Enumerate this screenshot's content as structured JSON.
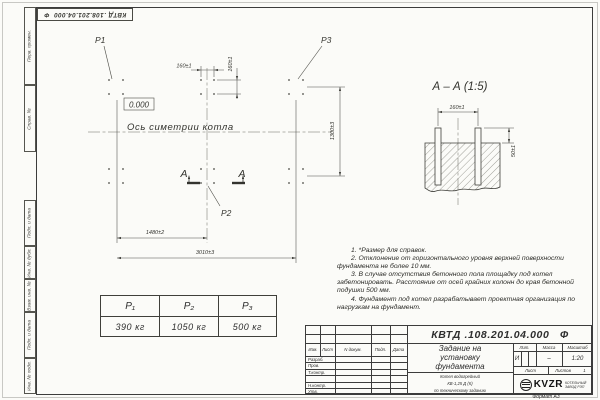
{
  "sheet": {
    "inverted_number": "КВТД .108.201.04.000  Ф",
    "format_note": "Формат А3"
  },
  "margin_labels": {
    "top": [
      "Перв. примен.",
      "Справ. №"
    ],
    "bottom": [
      "Подп. и дата",
      "Инв. № дубл.",
      "Взам. инв. №",
      "Подп. и дата",
      "Инв. № подл."
    ]
  },
  "plan": {
    "load_p1": "P1",
    "load_p2": "P2",
    "load_p3": "P3",
    "elevation": "0.000",
    "symmetry_axis": "Ось симетрии котла",
    "dim_bolt_spacing_x": "160±1",
    "dim_bolt_spacing_y": "160±1",
    "dim_half_length": "1480±2",
    "dim_full_length": "3010±3",
    "dim_width": "1300±3",
    "section_mark": "А"
  },
  "section": {
    "title": "А – А (1:5)",
    "dim_spacing": "160±1",
    "dim_height": "50±1"
  },
  "loads_table": {
    "headers": [
      "P₁",
      "P₂",
      "P₃"
    ],
    "values": [
      "390 кг",
      "1050 кг",
      "500 кг"
    ]
  },
  "notes": [
    "1. *Размер для справок.",
    "2. Отклонение от горизонтального уровня верхней поверхности фундамента не более 10 мм.",
    "3. В случае отсутствия бетонного пола площадку под котел забетонировать. Расстояние от осей крайних колонн до края бетонной подушки 500 мм.",
    "4. Фундамент под котел разрабатывает проектная организация по нагрузкам на фундамент."
  ],
  "title_block": {
    "doc_number": "КВТД .108.201.04.000   Ф",
    "title_lines": [
      "Задание на",
      "установку",
      "фундамента"
    ],
    "subtitle_lines": [
      "Котел водогрейный",
      "КВ-1,25 Д (К)",
      "по техническому заданию"
    ],
    "columns": [
      "Изм.",
      "Лист",
      "N докум.",
      "Подп.",
      "Дата"
    ],
    "rows": [
      "Разраб.",
      "Пров.",
      "Т.контр.",
      "",
      "Н.контр.",
      "Утв."
    ],
    "lit_label": "Лит.",
    "mass_label": "Масса",
    "scale_label": "Масштаб",
    "lit_value": "И",
    "mass_value": "–",
    "scale_value": "1:20",
    "sheet_label": "Лист",
    "sheets_label": "Листов",
    "sheets_value": "1",
    "company": {
      "logo": "KVZR",
      "caption_lines": [
        "КОТЕЛЬНЫЙ",
        "ЗАВОД РЭП"
      ]
    }
  }
}
